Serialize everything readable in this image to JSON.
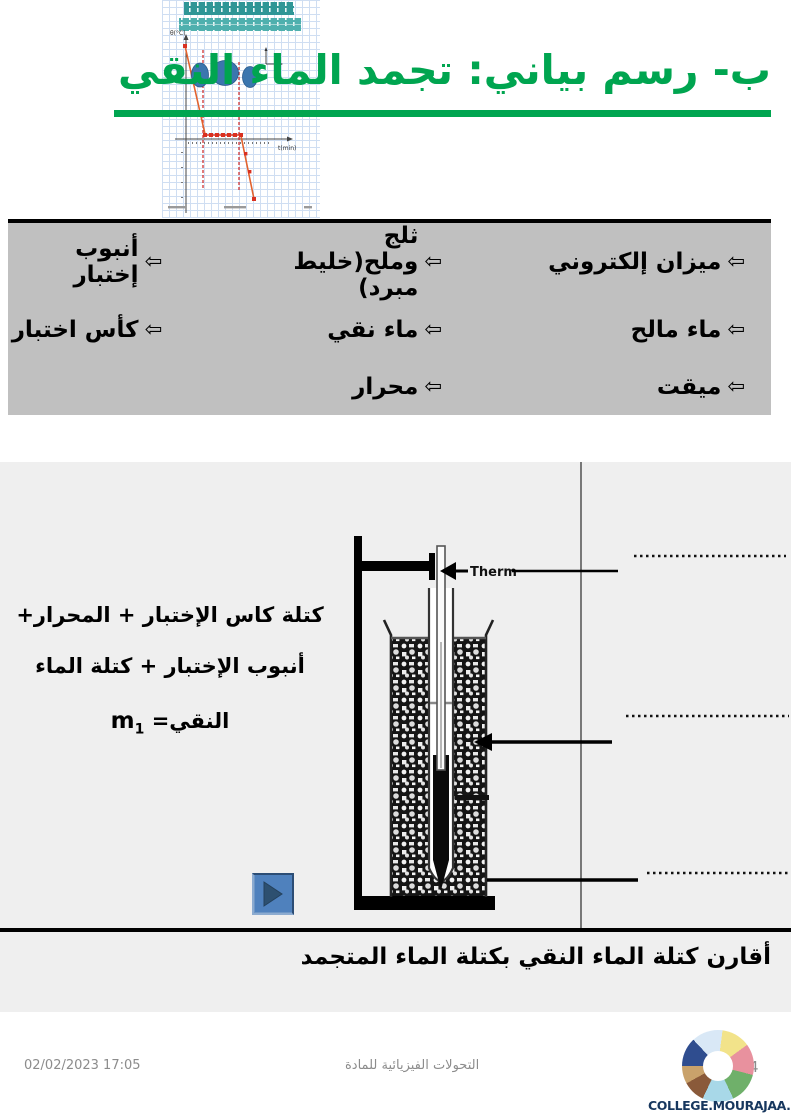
{
  "title": {
    "text": "ب- رسم بياني: تجمد الماء النقي"
  },
  "materials": {
    "arrow": "⇦",
    "col_right": [
      "ميزان إلكتروني",
      "ماء مالح",
      "ميقت"
    ],
    "col_middle": [
      "ثلج وملح(خليط مبرد)",
      "ماء نقي",
      "محرار"
    ],
    "col_left": [
      "أنبوب إختبار",
      "كأس اختبار"
    ]
  },
  "experiment": {
    "mass_line1": "كتلة كاس الإختبار +  المحرار+",
    "mass_line2": "أنبوب الإختبار + كتلة الماء",
    "mass_line3_text": "النقي= ",
    "mass_symbol": "m",
    "mass_subscript": "1",
    "therm_label": "Therm",
    "compare_text": "أقارن كتلة الماء النقي بكتلة الماء المتجمد"
  },
  "chart_data": {
    "type": "line",
    "title": "",
    "xlabel": "t(min)",
    "ylabel": "θ(°C)",
    "series": [
      {
        "name": "cooling curve of pure water",
        "x_estimated": [
          0,
          2,
          8,
          11
        ],
        "y_estimated": [
          15,
          0,
          0,
          -15
        ]
      }
    ],
    "plateau_y": 0,
    "grid": true,
    "legend_position": "none"
  },
  "footer": {
    "datetime": "02/02/2023 17:05",
    "course": "التحولات الفيزيائية للمادة",
    "page": "4",
    "site": "COLLEGE.MOURAJAA.COM"
  },
  "colors": {
    "title_green": "#00A550",
    "table_bg": "#C0C0C0",
    "section_bg": "#EFEFEF",
    "button_blue": "#4F81BD",
    "site_navy": "#17375E",
    "thumb_teal_dark": "#2F9696",
    "thumb_teal_light": "#4FB0AE",
    "curve_red": "#D93020"
  }
}
